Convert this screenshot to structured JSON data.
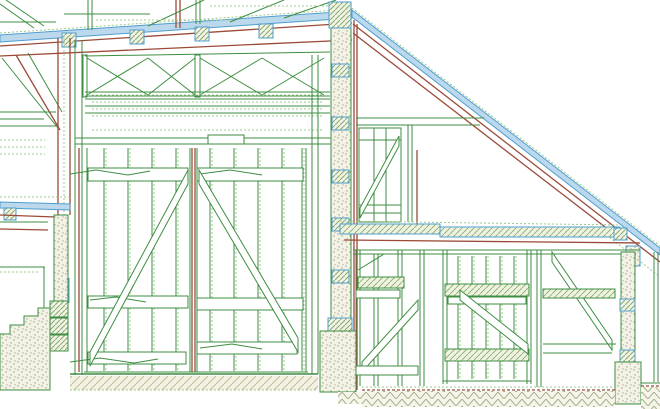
{
  "drawing": {
    "kind": "timber-frame-building-cross-section",
    "canvas": {
      "width": 660,
      "height": 409
    }
  },
  "colors": {
    "paper": "#ffffff",
    "line_green": "#3e8e41",
    "line_green_light": "#9ccb8e",
    "line_red": "#9c4a38",
    "line_blue": "#4f9ecf",
    "fill_blue_light": "#bcd8ec",
    "hatch_green": "#7fae6b",
    "stipple_dot": "#9aa585",
    "fill_pale": "#f4f2e6",
    "ground_hatch": "#a8b089",
    "floor_hatch": "#c2bc95"
  },
  "upper_roof": {
    "purlins_x": [
      62,
      130,
      195,
      259
    ],
    "purlin_size": 14
  },
  "center_post": {
    "section_marks_y": [
      64,
      117,
      170,
      218,
      270
    ]
  },
  "siding": {
    "solid_y": [
      92,
      99,
      106,
      113
    ],
    "dashed_y": [
      95,
      102,
      109,
      116,
      130
    ]
  },
  "main_door": {
    "left_planks_x": [
      104,
      128,
      152,
      176
    ],
    "right_planks_x": [
      210,
      234,
      258,
      282,
      302
    ],
    "plank_top_y": 148,
    "plank_bottom_y": 371
  },
  "lean_to_door": {
    "planks_x": [
      458,
      472,
      486,
      500,
      514
    ],
    "plank_top_y": 256,
    "plank_bottom_y": 379
  },
  "x_bracing": {
    "cells": [
      [
        87,
        148
      ],
      [
        148,
        195
      ],
      [
        200,
        262
      ],
      [
        262,
        324
      ]
    ],
    "top_y": 58,
    "bottom_y": 95
  }
}
